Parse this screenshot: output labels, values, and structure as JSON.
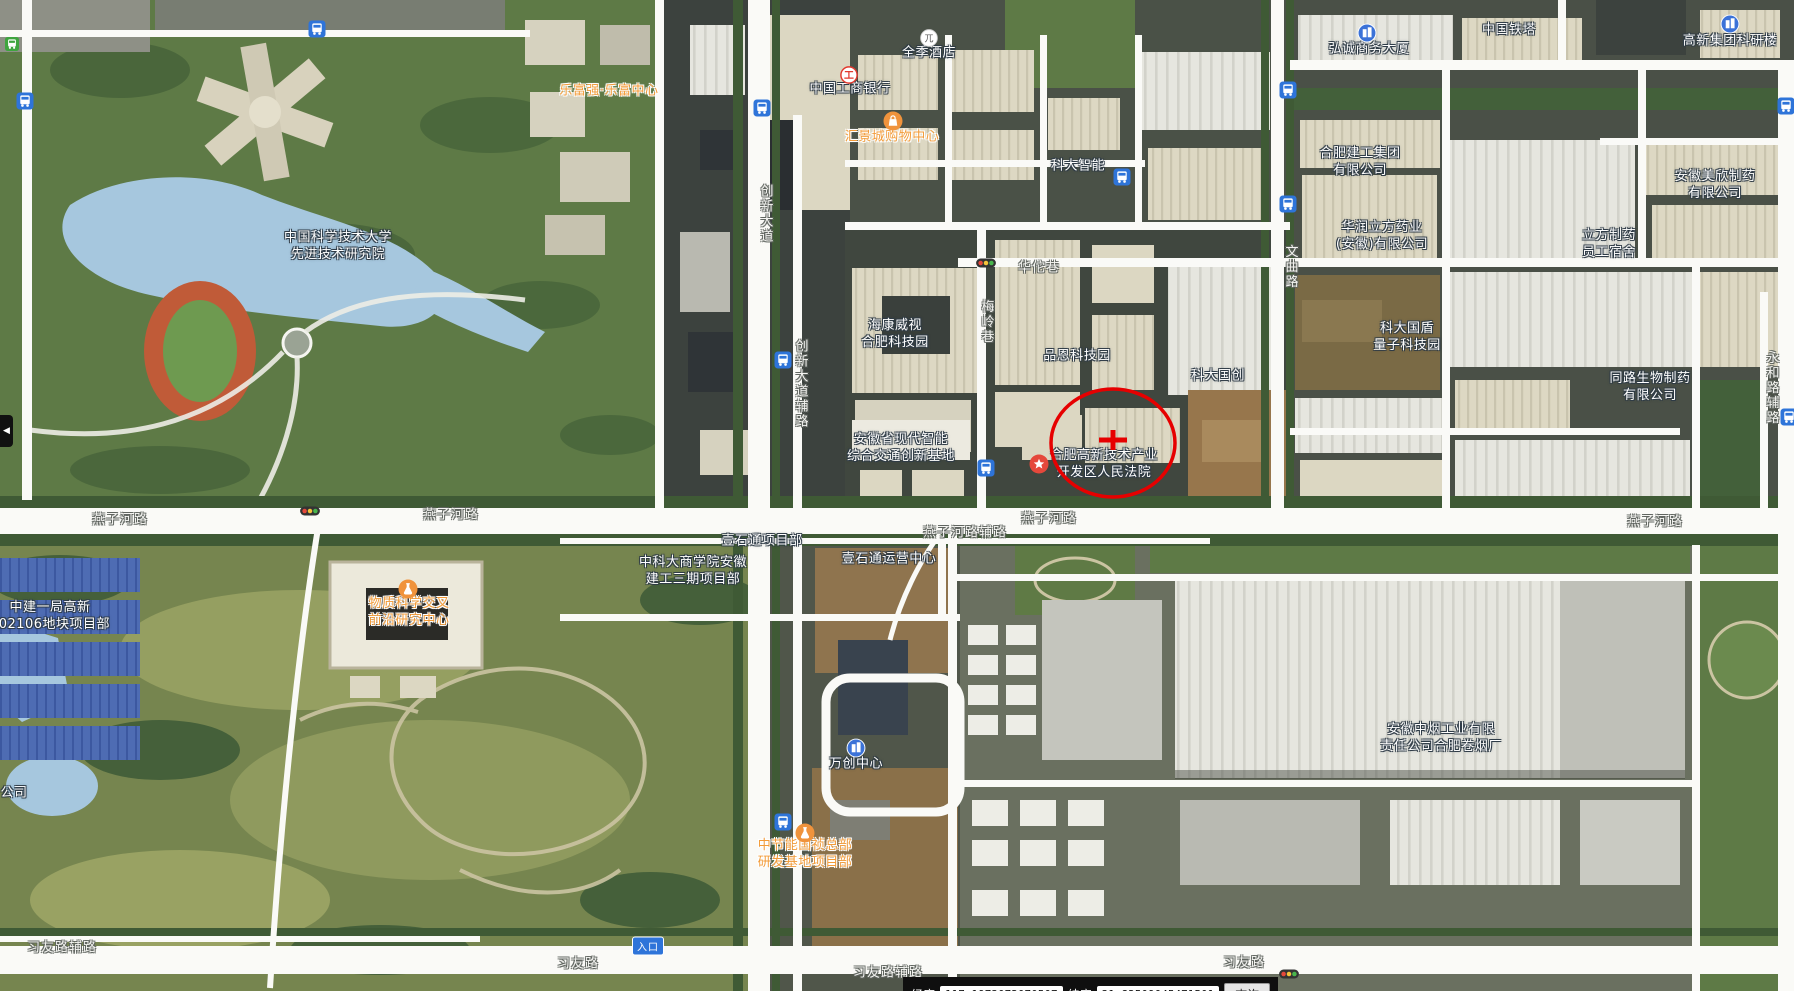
{
  "statusbar": {
    "lon_label": "经度",
    "lon_value": "117.1973072070507",
    "lat_label": "纬度",
    "lat_value": "31.82509045471501",
    "search_button": "查询"
  },
  "ui": {
    "left_tab_arrow": "◀"
  },
  "annotation": {
    "cx": 1113,
    "cy": 443,
    "rx": 62,
    "ry": 54,
    "cross_half_w": 14,
    "cross_half_h": 10,
    "color": "#E60000"
  },
  "place_labels": [
    {
      "name": "ustc-advanced-institute",
      "lines": [
        "中国科学技术大学",
        "先进技术研究院"
      ],
      "x": 338,
      "y": 247,
      "color": "white"
    },
    {
      "name": "lefuqiang-center",
      "lines": [
        "乐富强·乐富中心"
      ],
      "x": 609,
      "y": 92,
      "color": "orange"
    },
    {
      "name": "ji-hotel",
      "lines": [
        "全季酒店"
      ],
      "x": 929,
      "y": 54,
      "color": "white"
    },
    {
      "name": "icbc-bank",
      "lines": [
        "中国工商银行"
      ],
      "x": 850,
      "y": 90,
      "color": "white"
    },
    {
      "name": "huijingcheng-shopping-mall",
      "lines": [
        "汇景城购物中心"
      ],
      "x": 892,
      "y": 138,
      "color": "orange"
    },
    {
      "name": "keda-intelligence",
      "lines": [
        "科大智能"
      ],
      "x": 1078,
      "y": 167,
      "color": "white"
    },
    {
      "name": "china-tower",
      "lines": [
        "中国铁塔"
      ],
      "x": 1509,
      "y": 31,
      "color": "white"
    },
    {
      "name": "hongcheng-business-building",
      "lines": [
        "弘诚商务大厦"
      ],
      "x": 1369,
      "y": 50,
      "color": "white"
    },
    {
      "name": "gaoxin-group-research-building",
      "lines": [
        "高新集团科研楼"
      ],
      "x": 1730,
      "y": 42,
      "color": "white"
    },
    {
      "name": "hefei-jiangong-group",
      "lines": [
        "合肥建工集团",
        "有限公司"
      ],
      "x": 1360,
      "y": 163,
      "color": "white"
    },
    {
      "name": "huarun-lifang-pharma",
      "lines": [
        "华润立方药业",
        "(安徽)有限公司"
      ],
      "x": 1382,
      "y": 237,
      "color": "white"
    },
    {
      "name": "anhui-meixin-pharma",
      "lines": [
        "安徽美欣制药",
        "有限公司"
      ],
      "x": 1715,
      "y": 186,
      "color": "white"
    },
    {
      "name": "lifang-pharma-dormitory",
      "lines": [
        "立方制药",
        "员工宿舍"
      ],
      "x": 1609,
      "y": 245,
      "color": "white"
    },
    {
      "name": "hikvision-hefei-techpark",
      "lines": [
        "海康威视",
        "合肥科技园"
      ],
      "x": 895,
      "y": 335,
      "color": "white"
    },
    {
      "name": "pinen-techpark",
      "lines": [
        "品恩科技园"
      ],
      "x": 1077,
      "y": 357,
      "color": "white"
    },
    {
      "name": "keda-guochuang",
      "lines": [
        "科大国创"
      ],
      "x": 1218,
      "y": 377,
      "color": "white"
    },
    {
      "name": "keda-guodun-quantum-park",
      "lines": [
        "科大国盾",
        "量子科技园"
      ],
      "x": 1407,
      "y": 338,
      "color": "white"
    },
    {
      "name": "tonglu-bio-pharma",
      "lines": [
        "同路生物制药",
        "有限公司"
      ],
      "x": 1650,
      "y": 388,
      "color": "white"
    },
    {
      "name": "anhui-intelligent-transport-base",
      "lines": [
        "安徽省现代智能",
        "综合交通创新基地"
      ],
      "x": 901,
      "y": 449,
      "color": "white"
    },
    {
      "name": "hefei-hightech-court",
      "lines": [
        "合肥高新技术产业",
        "开发区人民法院"
      ],
      "x": 1104,
      "y": 465,
      "color": "white"
    },
    {
      "name": "zhongjian-project-dept",
      "lines": [
        "中建一局高新",
        "202106地块项目部"
      ],
      "x": 50,
      "y": 617,
      "color": "white"
    },
    {
      "name": "material-science-research-center",
      "lines": [
        "物质科学交叉",
        "前沿研究中心"
      ],
      "x": 409,
      "y": 613,
      "color": "orange"
    },
    {
      "name": "ustc-business-school-project",
      "lines": [
        "中科大商学院安徽",
        "建工三期项目部"
      ],
      "x": 693,
      "y": 572,
      "color": "white"
    },
    {
      "name": "yishitong-project-dept",
      "lines": [
        "壹石通项目部"
      ],
      "x": 762,
      "y": 542,
      "color": "white"
    },
    {
      "name": "yishitong-operation-center",
      "lines": [
        "壹石通运营中心"
      ],
      "x": 889,
      "y": 560,
      "color": "white"
    },
    {
      "name": "wanchuang-center",
      "lines": [
        "万创中心"
      ],
      "x": 856,
      "y": 765,
      "color": "white"
    },
    {
      "name": "zhongjieneng-guozhen-project",
      "lines": [
        "中节能国祯总部",
        "研发基地项目部"
      ],
      "x": 805,
      "y": 855,
      "color": "orange"
    },
    {
      "name": "anhui-zhongyan-cigarette-factory",
      "lines": [
        "安徽中烟工业有限",
        "责任公司合肥卷烟厂"
      ],
      "x": 1441,
      "y": 739,
      "color": "white"
    },
    {
      "name": "edge-clipped-company-label",
      "lines": [
        "公司"
      ],
      "x": 14,
      "y": 794,
      "color": "white"
    }
  ],
  "road_labels": [
    {
      "text": "燕子河路",
      "x": 120,
      "y": 518,
      "vertical": false
    },
    {
      "text": "燕子河路",
      "x": 451,
      "y": 513,
      "vertical": false
    },
    {
      "text": "燕子河路",
      "x": 1049,
      "y": 517,
      "vertical": false
    },
    {
      "text": "燕子河路",
      "x": 1655,
      "y": 520,
      "vertical": false
    },
    {
      "text": "燕子河路辅路",
      "x": 965,
      "y": 531,
      "vertical": false
    },
    {
      "text": "华佗巷",
      "x": 1039,
      "y": 266,
      "vertical": false
    },
    {
      "text": "创新大道",
      "x": 765,
      "y": 214,
      "vertical": true
    },
    {
      "text": "创新大道辅路",
      "x": 800,
      "y": 384,
      "vertical": true
    },
    {
      "text": "梅岭巷",
      "x": 986,
      "y": 322,
      "vertical": true
    },
    {
      "text": "文曲路",
      "x": 1290,
      "y": 267,
      "vertical": true
    },
    {
      "text": "永和路辅路",
      "x": 1771,
      "y": 388,
      "vertical": true
    },
    {
      "text": "习友路辅路",
      "x": 62,
      "y": 946,
      "vertical": false
    },
    {
      "text": "习友路",
      "x": 578,
      "y": 962,
      "vertical": false
    },
    {
      "text": "习友路辅路",
      "x": 888,
      "y": 971,
      "vertical": false
    },
    {
      "text": "习友路",
      "x": 1244,
      "y": 961,
      "vertical": false
    }
  ],
  "poi_icons": [
    {
      "type": "hotel",
      "name": "hotel-poi-icon",
      "x": 929,
      "y": 38
    },
    {
      "type": "bank",
      "name": "bank-poi-icon",
      "x": 849,
      "y": 75
    },
    {
      "type": "shopping",
      "name": "shopping-poi-icon",
      "x": 893,
      "y": 121
    },
    {
      "type": "star",
      "name": "court-poi-icon",
      "x": 1039,
      "y": 464
    },
    {
      "type": "flask",
      "name": "science-project-poi-icon",
      "x": 408,
      "y": 589
    },
    {
      "type": "flask",
      "name": "construction-project-poi-icon",
      "x": 805,
      "y": 833
    },
    {
      "type": "building",
      "name": "office-building-poi-icon",
      "x": 1367,
      "y": 33
    },
    {
      "type": "building",
      "name": "office-building-poi-icon",
      "x": 1730,
      "y": 24
    },
    {
      "type": "building",
      "name": "office-building-poi-icon",
      "x": 856,
      "y": 748
    }
  ],
  "transit_icons": [
    {
      "type": "bus",
      "x": 25,
      "y": 101
    },
    {
      "type": "bus",
      "x": 317,
      "y": 29
    },
    {
      "type": "bus",
      "x": 762,
      "y": 108
    },
    {
      "type": "bus",
      "x": 1122,
      "y": 177
    },
    {
      "type": "bus",
      "x": 1288,
      "y": 90
    },
    {
      "type": "bus",
      "x": 1786,
      "y": 106
    },
    {
      "type": "bus",
      "x": 783,
      "y": 360
    },
    {
      "type": "bus",
      "x": 986,
      "y": 468
    },
    {
      "type": "bus",
      "x": 1288,
      "y": 204
    },
    {
      "type": "bus",
      "x": 783,
      "y": 822
    },
    {
      "type": "bus",
      "x": 1789,
      "y": 417
    },
    {
      "type": "bus-green",
      "x": 12,
      "y": 44
    },
    {
      "type": "traffic-light",
      "x": 310,
      "y": 511
    },
    {
      "type": "traffic-light",
      "x": 986,
      "y": 263
    },
    {
      "type": "traffic-light",
      "x": 1289,
      "y": 974
    }
  ],
  "entrance_badge": {
    "text": "入口",
    "x": 648,
    "y": 946
  }
}
